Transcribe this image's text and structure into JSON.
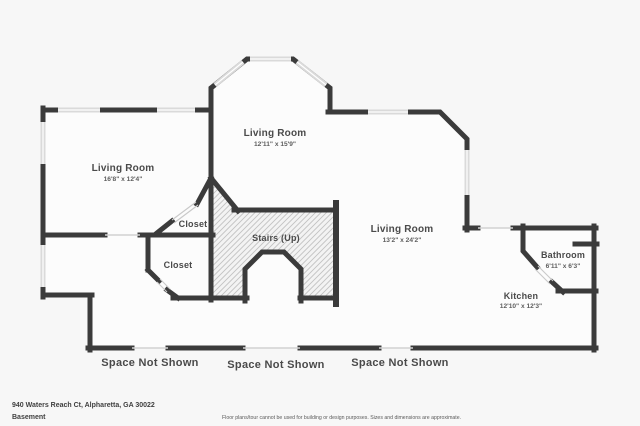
{
  "floorplan": {
    "rooms": [
      {
        "label": "Living Room",
        "dims": "16'8\" x 12'4\""
      },
      {
        "label": "Living Room",
        "dims": "12'11\" x 15'9\""
      },
      {
        "label": "Living Room",
        "dims": "13'2\" x 24'2\""
      },
      {
        "label": "Stairs (Up)"
      },
      {
        "label": "Closet"
      },
      {
        "label": "Closet"
      },
      {
        "label": "Bathroom",
        "dims": "6'11\" x 6'3\""
      },
      {
        "label": "Kitchen",
        "dims": "12'10\" x 12'3\""
      }
    ],
    "space_not_shown": [
      "Space Not Shown",
      "Space Not Shown",
      "Space Not Shown"
    ]
  },
  "footer": {
    "address": "940 Waters Reach Ct, Alpharetta, GA 30022",
    "floor_label": "Basement",
    "disclaimer": "Floor plans/tour cannot be used for building or design purposes. Sizes and dimensions are approximate."
  },
  "colors": {
    "wall": "#3b3b3b",
    "window": "#dadada",
    "hatch_line": "#c2c2c2",
    "background": "#f7f7f7",
    "room_fill": "#fcfcfc",
    "label_text": "#4a4a4a"
  }
}
